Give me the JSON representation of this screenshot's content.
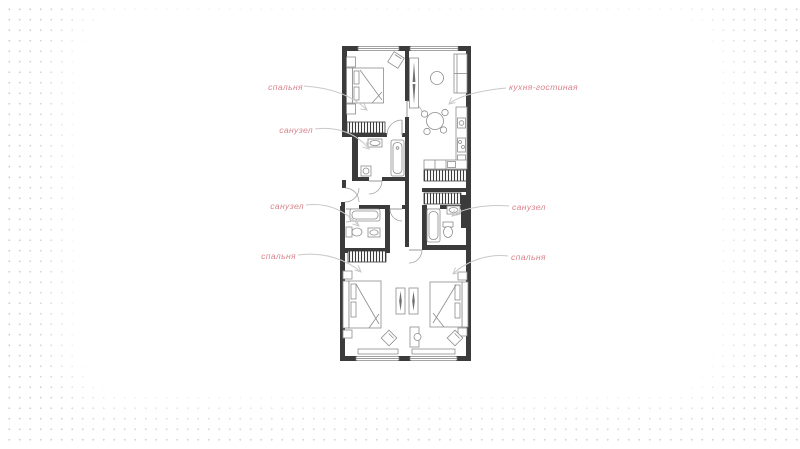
{
  "type": "floor-plan",
  "background": {
    "dot_color": "#d2d2d2",
    "base_color": "#ffffff"
  },
  "style": {
    "wall_color": "#3b3b3b",
    "furniture_color": "#8d8d8d",
    "window_color": "#7d7d7d",
    "label_color": "#d8868d",
    "arrow_color": "#c9c9c9"
  },
  "floor_plan": {
    "rooms": [
      {
        "id": "bedroom-top",
        "label": "спальня"
      },
      {
        "id": "bathroom-top",
        "label": "санузел"
      },
      {
        "id": "kitchen-living",
        "label": "кухня-гостиная"
      },
      {
        "id": "bathroom-mid-left",
        "label": "санузел"
      },
      {
        "id": "bathroom-mid-right",
        "label": "санузел"
      },
      {
        "id": "bedroom-bottom-left",
        "label": "спальня"
      },
      {
        "id": "bedroom-bottom-right",
        "label": "спальня"
      }
    ]
  }
}
